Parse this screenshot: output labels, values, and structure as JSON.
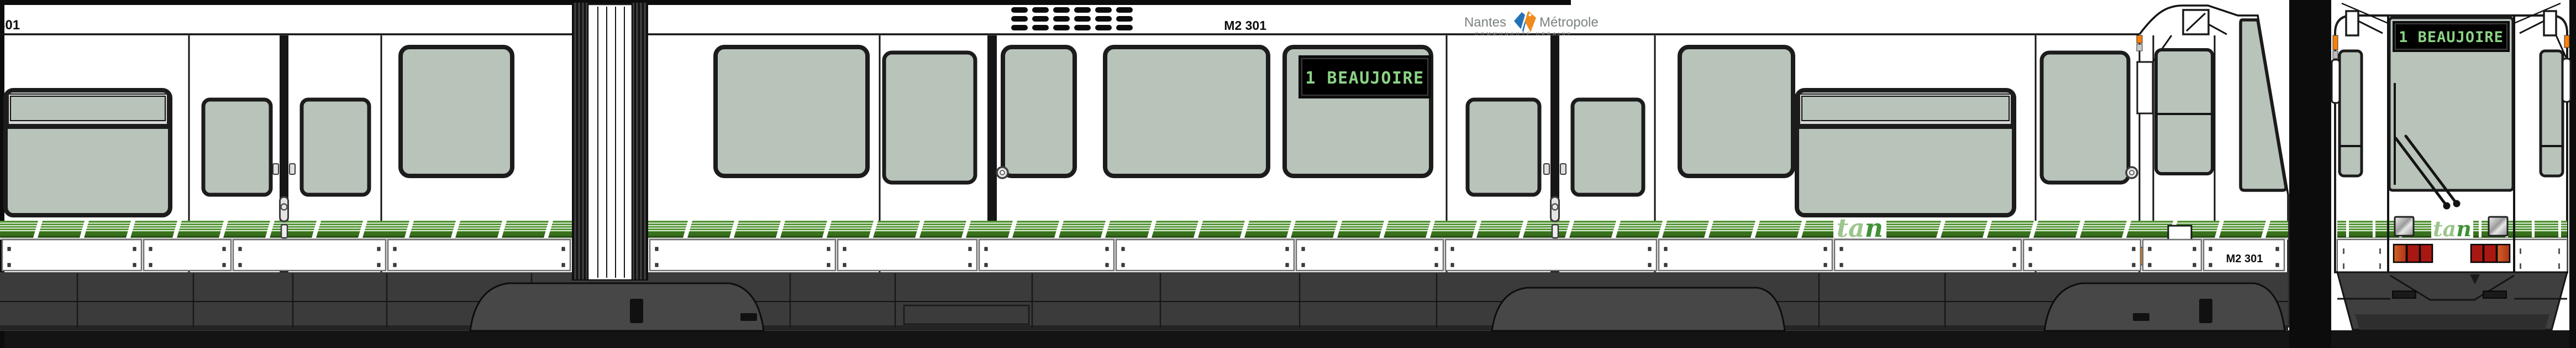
{
  "vehicle": {
    "side": {
      "cut_number": "301",
      "roof_number": "M2 301",
      "destination_display": "1 BEAUJOIRE",
      "skirt_number": "M2 301"
    },
    "front": {
      "destination_display": "1 BEAUJOIRE"
    }
  },
  "branding": {
    "operator_word1": "Nantes",
    "operator_word2": "Métropole",
    "operator_subtitle": "COMMUNAUTÉ URBAINE",
    "tan_logo_ta": "ta",
    "tan_logo_n": "n"
  },
  "colors": {
    "band_green": "#4f9232",
    "band_green_dark": "#38701d",
    "band_green_edge": "#234c0e",
    "glass": "#b8c3ba",
    "display_bg": "#242424",
    "display_text": "#8bd385",
    "marker_orange": "#f97f06",
    "tail_red": "#a81812",
    "tail_red_orange": "#c9511b",
    "underbody": "#3b3b3b",
    "bogie": "#474747",
    "ground": "#141414",
    "tan_light": "#9cc58b",
    "tan_dark": "#3f9336"
  }
}
